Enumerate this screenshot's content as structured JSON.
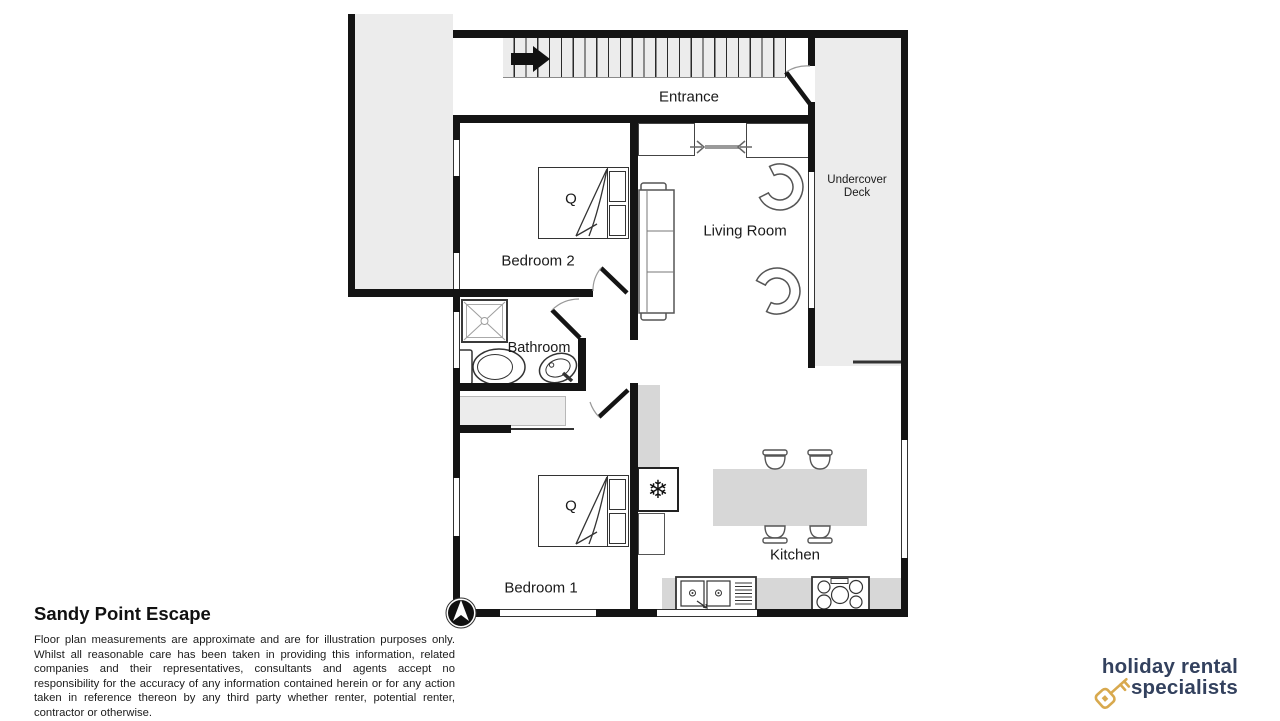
{
  "plan": {
    "labels": {
      "entrance": "Entrance",
      "bedroom2": "Bedroom 2",
      "living_room": "Living Room",
      "undercover_deck": "Undercover Deck",
      "bathroom": "Bathroom",
      "bedroom1": "Bedroom 1",
      "kitchen": "Kitchen",
      "bed_queen": "Q"
    },
    "icons": {
      "fridge_snowflake": "❄",
      "stairs_direction": "right-arrow",
      "north_indicator": "north-arrow",
      "logo_key": "key"
    }
  },
  "footer": {
    "title": "Sandy Point Escape",
    "disclaimer": "Floor plan measurements are approximate and are for illustration purposes only. Whilst all reasonable care has been taken in providing this information, related companies and their representatives, consultants and agents accept no responsibility for the accuracy of any information contained herein or for any action taken in reference thereon by any third party whether renter, potential renter, contractor or otherwise."
  },
  "branding": {
    "logo_line1": "holiday rental",
    "logo_line2": "specialists",
    "logo_text_color": "#33415e",
    "logo_key_color": "#d8a94e"
  },
  "palette": {
    "wall": "#141414",
    "area_light": "#ececec",
    "area_mid": "#d7d7d7"
  }
}
